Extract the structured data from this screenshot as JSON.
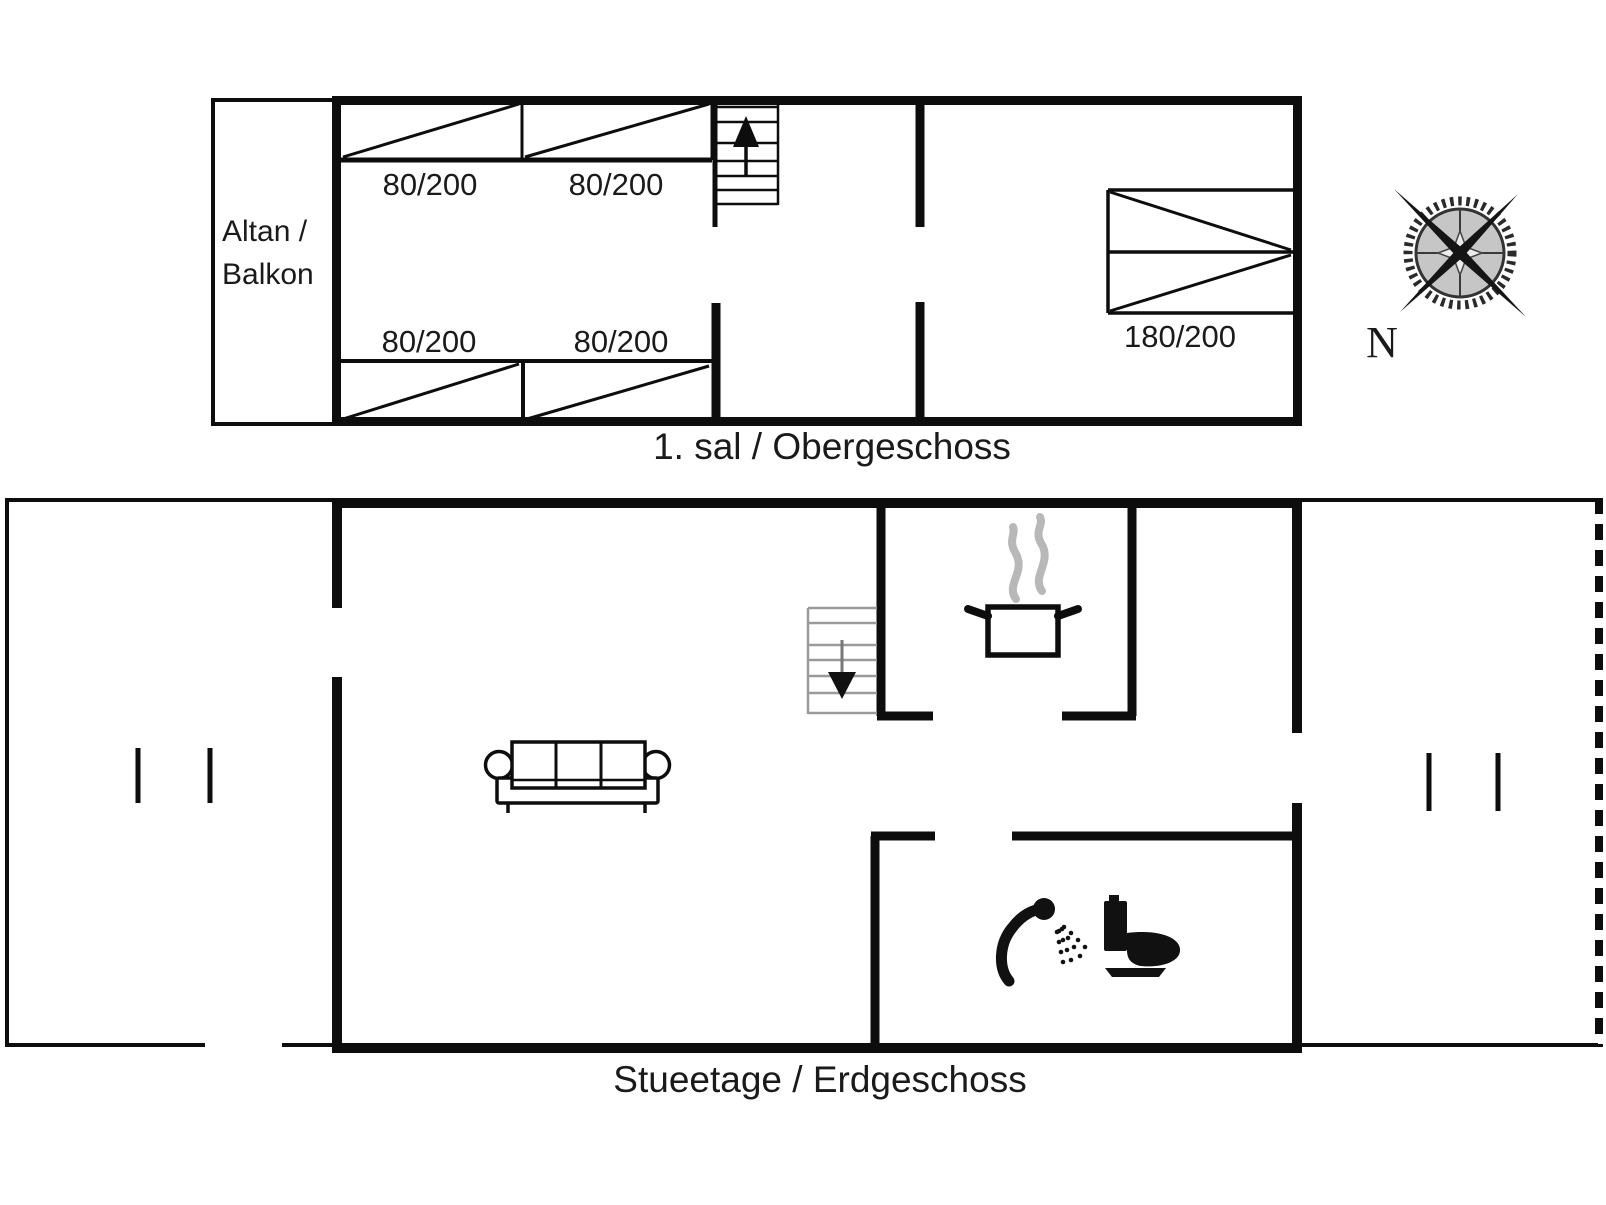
{
  "upper_floor": {
    "section_label": "1. sal / Obergeschoss",
    "balcony_label_line1": "Altan /",
    "balcony_label_line2": "Balkon",
    "beds": {
      "top_left": "80/200",
      "top_right": "80/200",
      "bottom_left": "80/200",
      "bottom_right": "80/200",
      "double": "180/200"
    }
  },
  "ground_floor": {
    "section_label": "Stueetage / Erdgeschoss"
  },
  "compass": {
    "north_label": "N"
  },
  "colors": {
    "wall": "#0d0d0d",
    "stairs_gray": "#9a9a9a",
    "steam_gray": "#b8b8b8",
    "text": "#1a1a1a"
  }
}
